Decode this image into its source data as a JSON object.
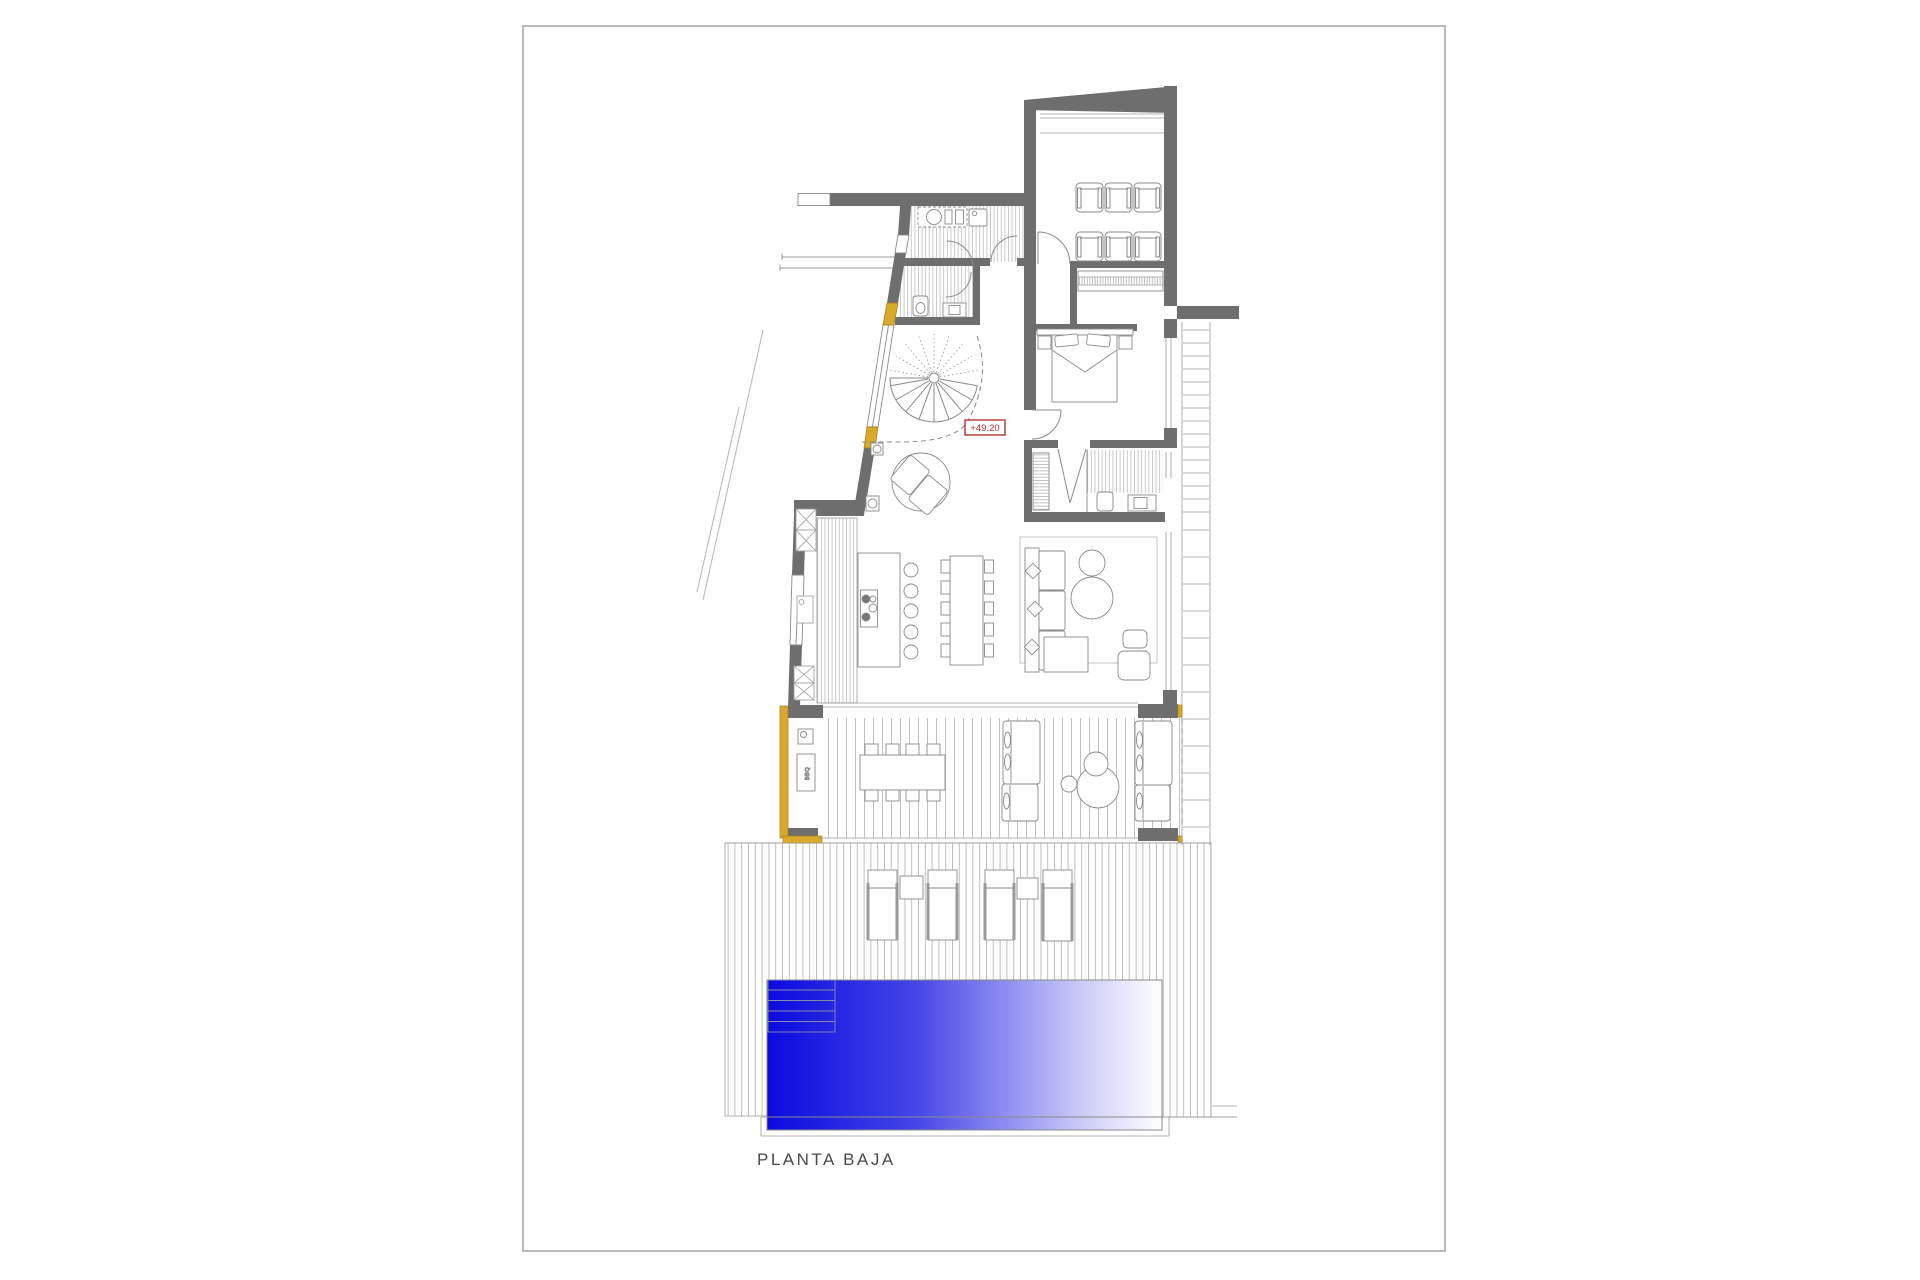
{
  "sheet": {
    "title": "PLANTA BAJA",
    "level_label": "+49.20",
    "bbq_label": "BBQ"
  },
  "colors": {
    "wall": "#6e6e6e",
    "page_border": "#b9b9b9",
    "line": "#8a8a8a",
    "accent_yellow": "#d9a92b",
    "label_red": "#b5332e",
    "pool_blue_deep": "#0a0ae0",
    "pool_blue_mid": "#4646e8",
    "pool_blue_light": "#ccccf8",
    "pool_white": "#ffffff",
    "text": "#4a4a4a"
  }
}
